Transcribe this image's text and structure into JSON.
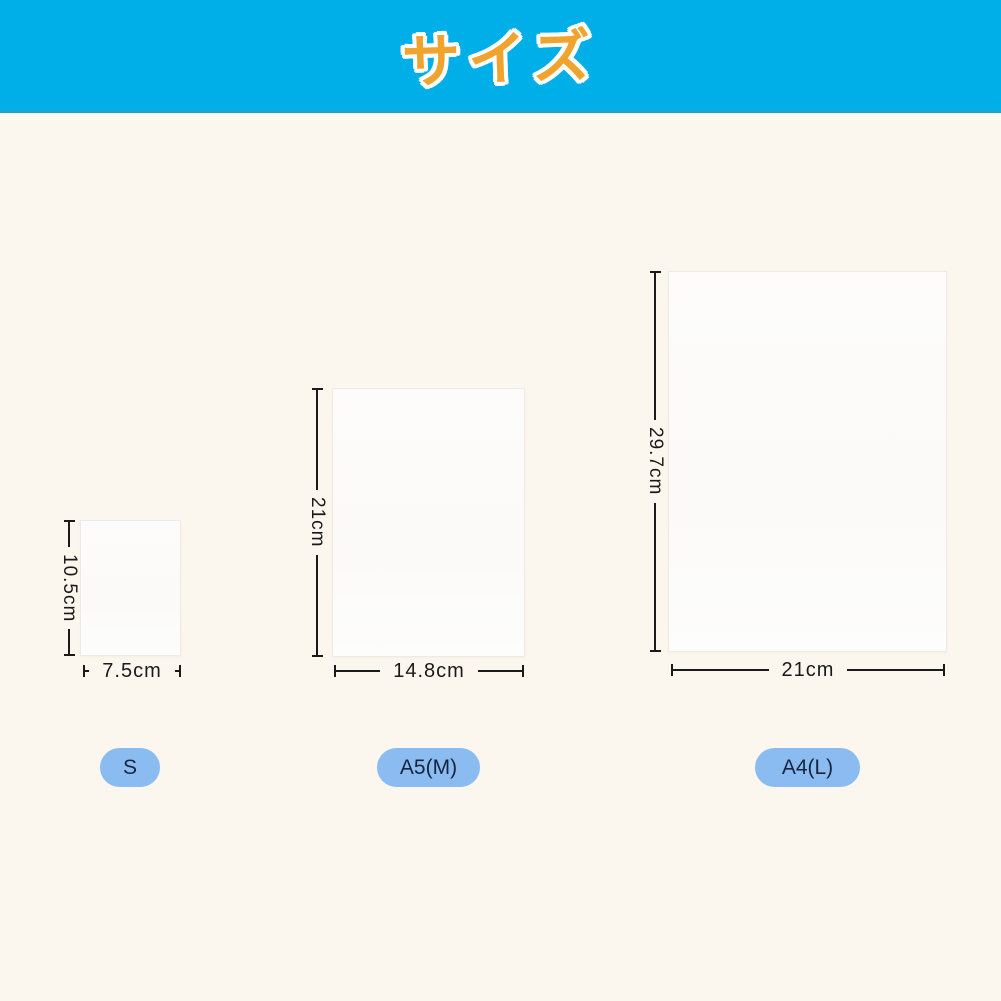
{
  "page": {
    "background_color": "#FCF7EE"
  },
  "header": {
    "title": "サイズ",
    "band_color": "#00AEE8",
    "title_color": "#F0A42E",
    "title_outline_color": "#FFFFFF"
  },
  "sizes": [
    {
      "badge": "S",
      "height_label": "10.5cm",
      "width_label": "7.5cm",
      "height_cm": 10.5,
      "width_cm": 7.5
    },
    {
      "badge": "A5(M)",
      "height_label": "21cm",
      "width_label": "14.8cm",
      "height_cm": 21,
      "width_cm": 14.8
    },
    {
      "badge": "A4(L)",
      "height_label": "29.7cm",
      "width_label": "21cm",
      "height_cm": 29.7,
      "width_cm": 21
    }
  ],
  "badge_style": {
    "background_color": "#8ABCF1",
    "text_color": "#17243E"
  },
  "dimension_line_color": "#1B1B1B"
}
